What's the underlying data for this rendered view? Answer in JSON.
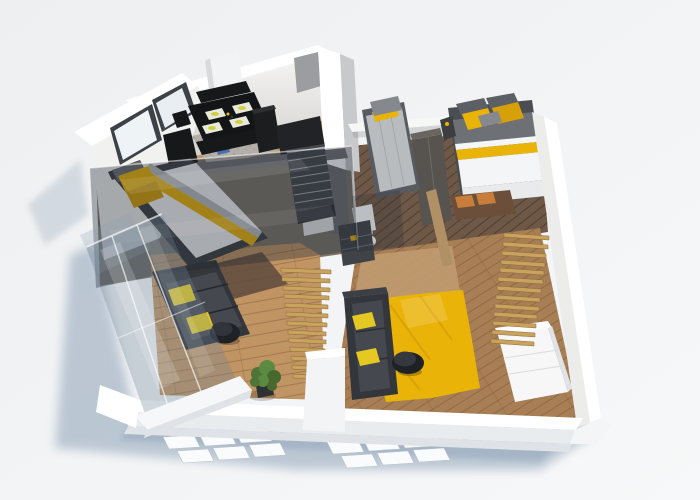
{
  "palette": {
    "bg1": "#eef0f2",
    "bg2": "#f8f9fa",
    "shadow": "#8fa3b8",
    "shadowSoft": "#b6c2ce",
    "windowPane": "#fafbfc",
    "wallWhite": "#ffffff",
    "wallFace": "#f1f1ef",
    "wallShade": "#dfe3e7",
    "wallGrayFace": "#c7c9cb",
    "wallDarkFace": "#9b9da0",
    "woodKitchen": "#c49a6d",
    "woodLight": "#c09463",
    "woodMid": "#a87e54",
    "woodPale": "#c29c72",
    "woodDark": "#6e5847",
    "slat": "#c9a25e",
    "slatEdge": "#8a6b3a",
    "black": "#17181a",
    "darkFurn": "#2a2d31",
    "sofa": "#33363b",
    "sofaSeat": "#45484e",
    "accent": "#eab308",
    "accentDeep": "#d79f08",
    "accentPale": "#e5c922",
    "rugGray": "#b3aea7",
    "bedWhite": "#f4f5f6",
    "bedGray": "#b9bcbf",
    "pillowGray": "#6d7075",
    "steel": "#85888d",
    "benchWood": "#6b4f3a",
    "cushionOrange": "#c87e3a",
    "glass": "rgba(110,130,150,0.32)",
    "glassEdge": "rgba(255,255,255,0.65)",
    "overlay": "rgba(33,41,54,0.36)",
    "plant1": "#4e7438",
    "plant2": "#5c8a42",
    "plant3": "#47682f",
    "potDark": "#2e3033"
  },
  "objects": {
    "scene": "3D apartment floor plan render",
    "kitchen": "kitchen and dining area",
    "diningTable": "black dining table with four yellow place settings",
    "bedLeft": "double bed with yellow pillows under glass roof",
    "bedSingle": "single bed with gray duvet",
    "bedRight": "double bed with yellow and gray pillows",
    "sofaLeft": "dark sofa with yellow cushions",
    "sofaRight": "dark sofa with yellow cushions",
    "rugYellow": "yellow area rug",
    "stairs": "wooden slat staircase",
    "slatScreen": "wooden slat screen",
    "glassWall": "glass facade wall",
    "plant": "green potted plant",
    "dresser": "white dresser"
  }
}
